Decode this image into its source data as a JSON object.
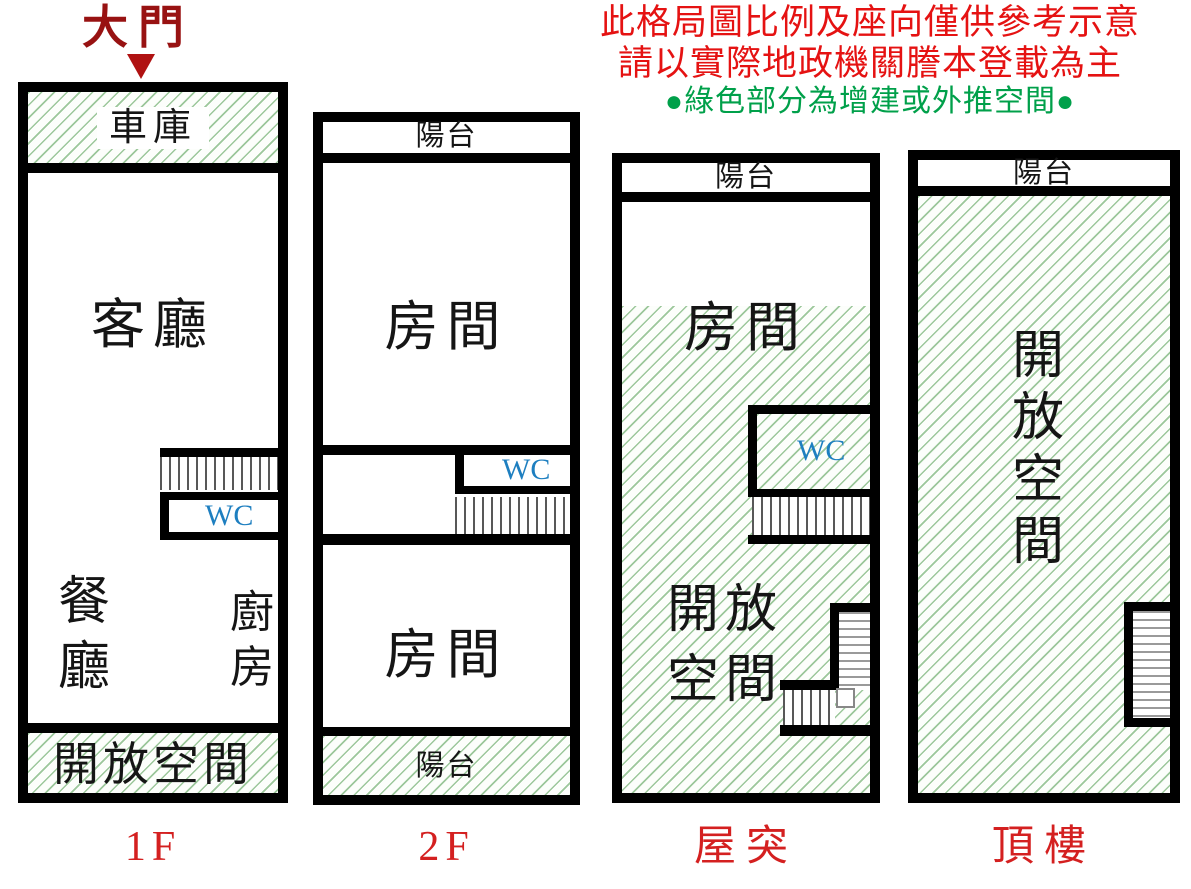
{
  "disclaimer": {
    "line1": "此格局圖比例及座向僅供參考示意",
    "line2": "請以實際地政機關謄本登載為主",
    "line3": "●綠色部分為增建或外推空間●"
  },
  "main_door": {
    "label": "大門"
  },
  "legend_meaning": "green hatch = added or pushed-out space",
  "floors": [
    {
      "name": "1F",
      "rooms": {
        "garage": "車庫",
        "living": "客廳",
        "wc": "WC",
        "dining": "餐廳",
        "kitchen": "廚房",
        "open_space": "開放空間"
      }
    },
    {
      "name": "2F",
      "rooms": {
        "balcony_top": "陽台",
        "room_upper": "房間",
        "wc": "WC",
        "room_lower": "房間",
        "balcony_bottom": "陽台"
      }
    },
    {
      "name": "屋突",
      "rooms": {
        "balcony": "陽台",
        "room": "房間",
        "wc": "WC",
        "open_space": "開放空間"
      }
    },
    {
      "name": "頂樓",
      "rooms": {
        "balcony": "陽台",
        "open_space": "開放空間"
      }
    }
  ],
  "colors": {
    "disclaimer_red": "#e51212",
    "note_green": "#00a04a",
    "door_red": "#981212",
    "floor_label_red": "#d42020",
    "wc_blue": "#1e7fc0",
    "wall_black": "#000000",
    "hatch_green": "#3c913c"
  }
}
